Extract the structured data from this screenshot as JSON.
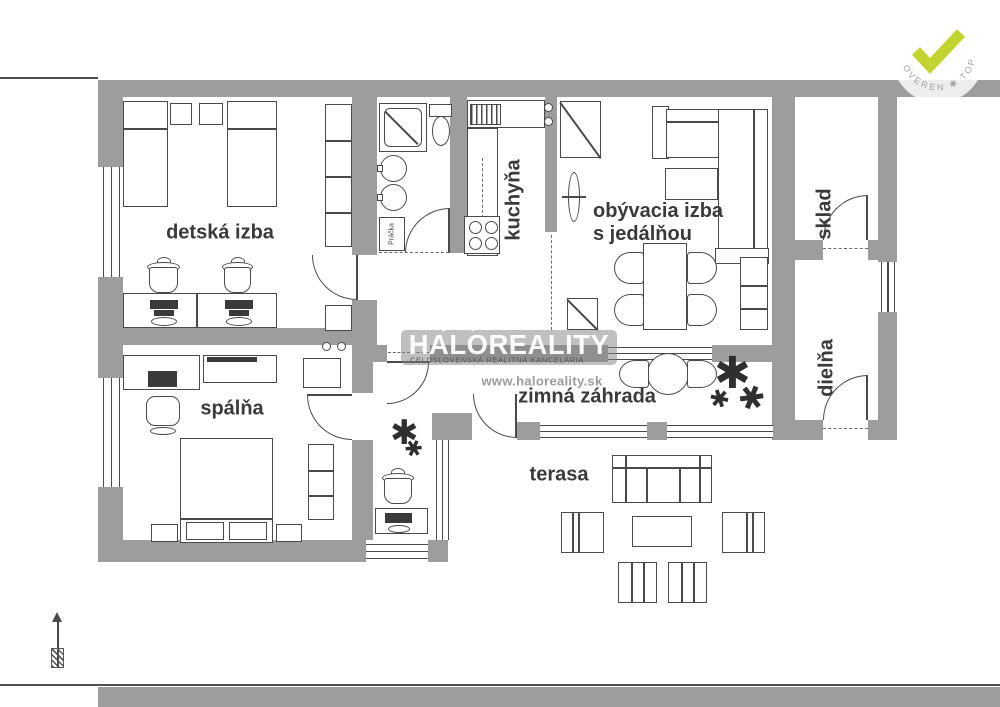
{
  "plan": {
    "rooms": [
      {
        "id": "detska-izba",
        "label": "detská izba"
      },
      {
        "id": "kuchyna",
        "label": "kuchyňa"
      },
      {
        "id": "obyvacia-izba",
        "label_line1": "obývacia izba",
        "label_line2": "s jedálňou"
      },
      {
        "id": "sklad",
        "label": "sklad"
      },
      {
        "id": "dielna",
        "label": "dielňa"
      },
      {
        "id": "spalna",
        "label": "spálňa"
      },
      {
        "id": "zimna-zahrada",
        "label": "zimná záhrada"
      },
      {
        "id": "terasa",
        "label": "terasa"
      }
    ],
    "appliance_labels": {
      "washer": "Práčka"
    }
  },
  "watermark": {
    "brand": "HALOREALITY",
    "tagline": "CELOSLOVENSKÁ REALITNÁ KANCELÁRIA",
    "website": "www.haloreality.sk"
  },
  "badge": {
    "arc_text": "OVEREN ✱ TOP"
  },
  "colors": {
    "wall": "#9d9d9d",
    "line": "#4a4a4a",
    "check": "#c3d330",
    "watermark_box": "rgba(130,130,130,0.5)"
  }
}
